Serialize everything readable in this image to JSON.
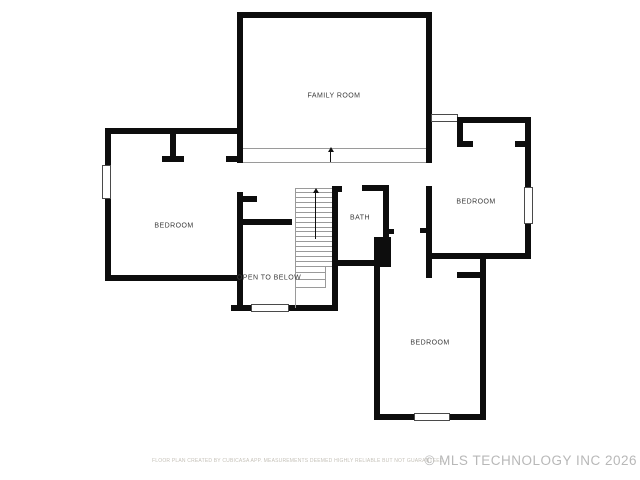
{
  "labels": {
    "family_room": "FAMILY ROOM",
    "bedroom_left": "BEDROOM",
    "bath": "BATH",
    "bedroom_right": "BEDROOM",
    "open_to_below": "OPEN TO BELOW",
    "bedroom_bottom": "BEDROOM"
  },
  "stairs": {
    "tread_count": 16,
    "direction_icon": "up-arrow"
  },
  "footer": {
    "disclaimer": "FLOOR PLAN CREATED BY CUBICASA APP. MEASUREMENTS DEEMED HIGHLY RELIABLE BUT NOT GUARANTEED",
    "watermark": "© MLS TECHNOLOGY INC 2026"
  },
  "colors": {
    "wall": "#0d0d0d",
    "label": "#3a3a3a",
    "footer": "#c6c2b9",
    "watermark": "#b8b8b8",
    "tread": "#9a9a9a"
  }
}
